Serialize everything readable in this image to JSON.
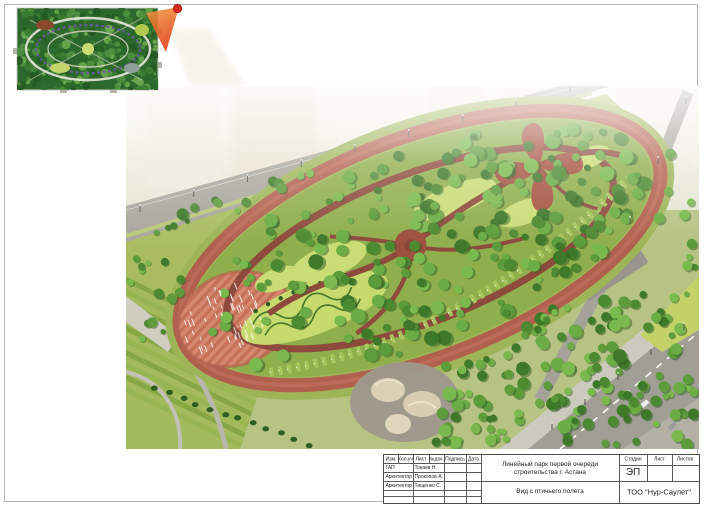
{
  "title_block": {
    "rev_header": [
      "Изм.",
      "Кол.уч",
      "Лист",
      "№док.",
      "Подпись",
      "Дата"
    ],
    "personnel": [
      {
        "role": "ГАП",
        "name": "Токаев Н."
      },
      {
        "role": "Архитектор",
        "name": "Прокопов А."
      },
      {
        "role": "Архитектор",
        "name": "Тищенко С."
      }
    ],
    "project_title_line1": "Линейный парк первой очереди",
    "project_title_line2": "строительства г. Астана",
    "view_title": "Вид с птичьего полета",
    "stage_header": {
      "stage": "Стадия",
      "sheet": "Лист",
      "sheets": "Листов"
    },
    "stage_value": "ЭП",
    "company": "ТОО \"Нур-Саулет\""
  },
  "colors": {
    "track": "#b2604e",
    "park_path": "#8e4a3c",
    "lawn": "#8fae4c",
    "road": "#a8a69c",
    "marker_red": "#d8281c",
    "tree_palette": [
      "#3e7829",
      "#4c8a31",
      "#5c9c3a",
      "#6bac44",
      "#7ab94e"
    ],
    "inset_palette": [
      "#245a24",
      "#2e6b2c",
      "#3c7c34",
      "#4f9140",
      "#6aa94e"
    ]
  }
}
